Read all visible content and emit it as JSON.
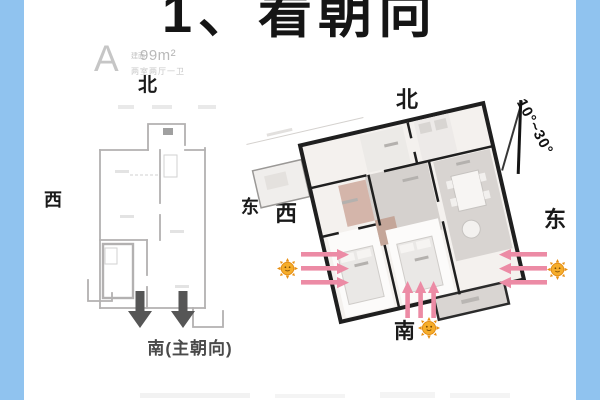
{
  "page": {
    "title": "1、看朝向",
    "side_bar_color": "#90c3ef",
    "background_color": "#ffffff"
  },
  "left_plan": {
    "unit_label": "A",
    "area_prefix": "建面",
    "area_value": "99m²",
    "rooms_text": "两室两厅一卫",
    "north": "北",
    "west": "西",
    "east": "东",
    "south_label": "南(主朝向)",
    "line_color": "#b3b1b1",
    "arrow_color": "#565656"
  },
  "right_plan": {
    "north": "北",
    "west": "西",
    "east": "东",
    "south_label": "南",
    "angle_label": "10°~30°",
    "wall_color": "#1f1f1f",
    "sun_color": "#f3a01e",
    "sunlight_arrow_color": "#ec8ba5"
  }
}
